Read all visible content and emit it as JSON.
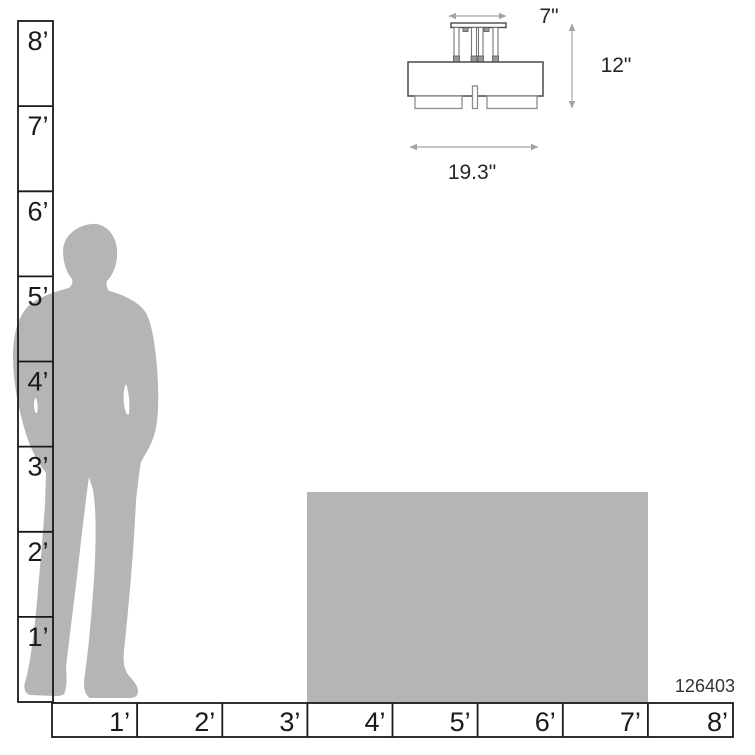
{
  "product": {
    "code": "126403"
  },
  "fixture_dimensions": {
    "canopy_width": "7\"",
    "height": "12\"",
    "width": "19.3\""
  },
  "rulers": {
    "vertical": {
      "labels": [
        "8’",
        "7’",
        "6’",
        "5’",
        "4’",
        "3’",
        "2’",
        "1’"
      ]
    },
    "horizontal": {
      "labels": [
        "1’",
        "2’",
        "3’",
        "4’",
        "5’",
        "6’",
        "7’",
        "8’"
      ]
    }
  },
  "colors": {
    "silhouette_gray": "#b5b5b5",
    "box_gray": "#b5b5b5",
    "ruler_line": "#1a1a1a",
    "dimension_line": "#a3a3a3",
    "fixture_outline": "#4a4a4a",
    "fixture_detail": "#8c8c8c",
    "text": "#262626"
  }
}
